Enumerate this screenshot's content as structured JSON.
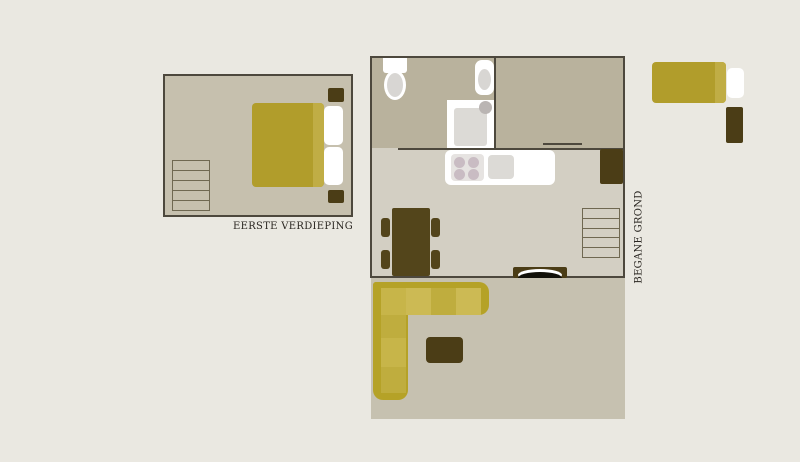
{
  "labels": {
    "first_floor": "EERSTE VERDIEPING",
    "ground_floor": "BEGANE GROND"
  },
  "colors": {
    "page_bg": "#eae8e1",
    "wall": "#4d483d",
    "floor_light": "#d3cfc3",
    "floor_tan": "#c6c0ae",
    "floor_dark": "#b9b29d",
    "floor_living": "#c6c1b0",
    "thin_line": "#6f6851",
    "olive": "#b19d2b",
    "olive_light": "#c0ad45",
    "sofa_base": "#b5a227",
    "cushion_a": "#c7b549",
    "cushion_a2": "#ccba54",
    "cushion_b": "#bfad3e",
    "brown": "#4b3d16",
    "table_brown": "#53451b",
    "fixture_gray": "#dcdad6",
    "burner": "#c9bcc3",
    "text": "#2a2621"
  },
  "plans": [
    {
      "id": "first-floor",
      "label": "EERSTE VERDIEPING",
      "rooms": [
        "bedroom"
      ],
      "furniture": [
        "stairs",
        "double-bed",
        "pillow",
        "pillow",
        "nightstand",
        "nightstand"
      ]
    },
    {
      "id": "ground-floor",
      "label": "BEGANE GROND",
      "rooms": [
        "bathroom",
        "bedroom",
        "kitchen-dining",
        "living-room"
      ],
      "furniture": [
        "toilet",
        "washbasin",
        "shower",
        "single-bed",
        "nightstand",
        "kitchen-counter",
        "stove",
        "kitchen-sink",
        "wardrobe",
        "stairs",
        "dining-table",
        "chair",
        "chair",
        "chair",
        "chair",
        "fireplace",
        "corner-sofa",
        "coffee-table"
      ]
    }
  ]
}
